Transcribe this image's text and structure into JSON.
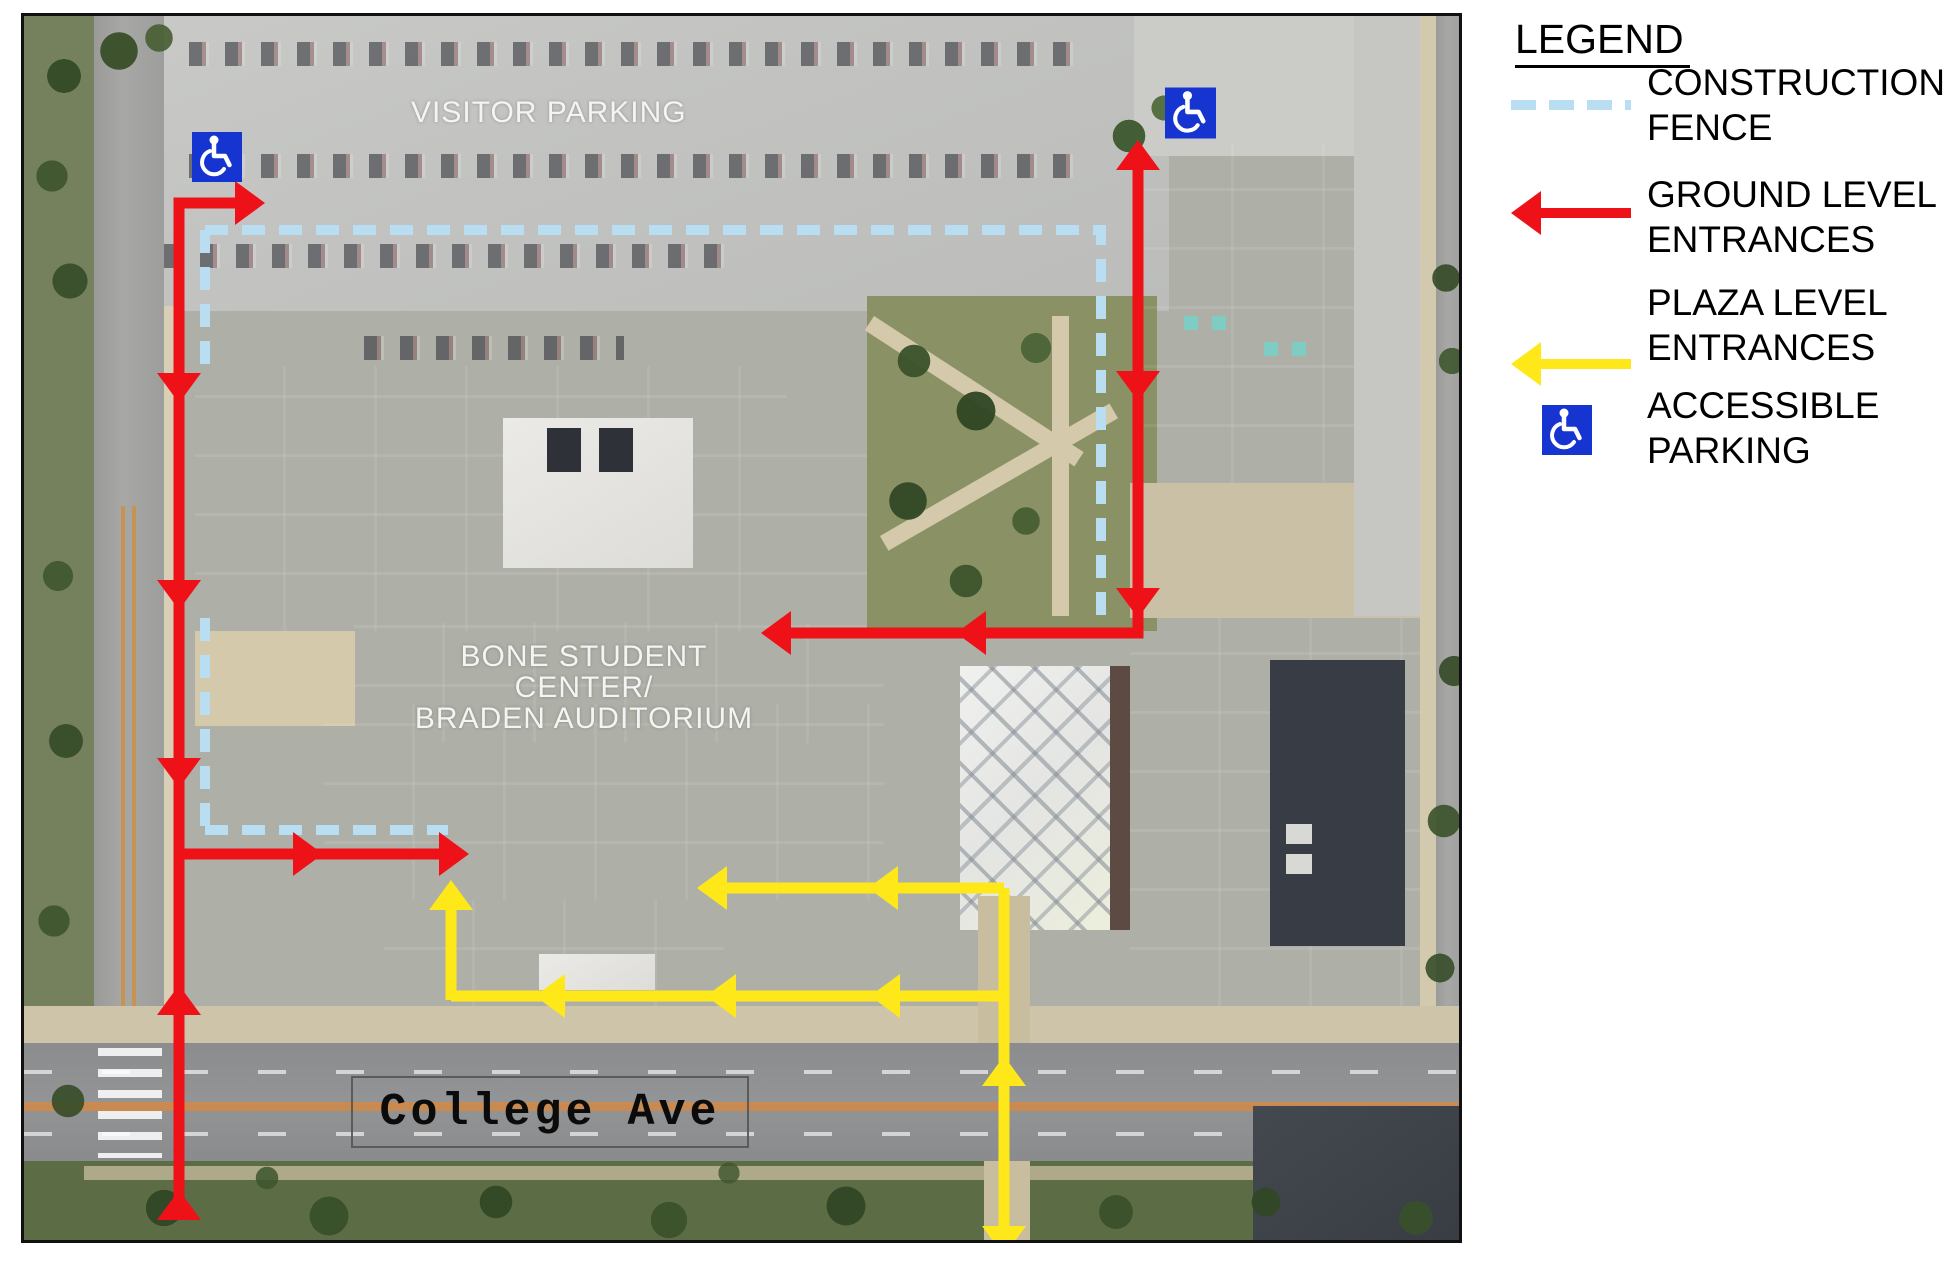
{
  "legend": {
    "title": "LEGEND",
    "items": [
      {
        "id": "construction-fence",
        "line1": "CONSTRUCTION",
        "line2": "FENCE",
        "symbol": "dashed-line-sample",
        "color": "#b9def1"
      },
      {
        "id": "ground-level-entrances",
        "line1": "GROUND LEVEL",
        "line2": "ENTRANCES",
        "symbol": "red-arrow-left",
        "color": "#ef1118"
      },
      {
        "id": "plaza-level-entrances",
        "line1": "PLAZA LEVEL",
        "line2": "ENTRANCES",
        "symbol": "yellow-arrow-left",
        "color": "#ffe81a"
      },
      {
        "id": "accessible-parking",
        "line1": "ACCESSIBLE",
        "line2": "PARKING",
        "symbol": "wheelchair-icon",
        "color": "#1634d0"
      }
    ]
  },
  "map": {
    "labels": {
      "visitor_parking": "VISITOR PARKING",
      "building_line1": "BONE STUDENT CENTER/",
      "building_line2": "BRADEN AUDITORIUM",
      "street": "College Ave"
    },
    "icons": {
      "accessible_parking": "wheelchair-icon",
      "accessible_parking_count": 2
    },
    "colors": {
      "ground_level_route": "#ef1118",
      "plaza_level_route": "#ffe81a",
      "construction_fence": "#b9def1",
      "accessible_parking_sign": "#1634d0"
    }
  }
}
